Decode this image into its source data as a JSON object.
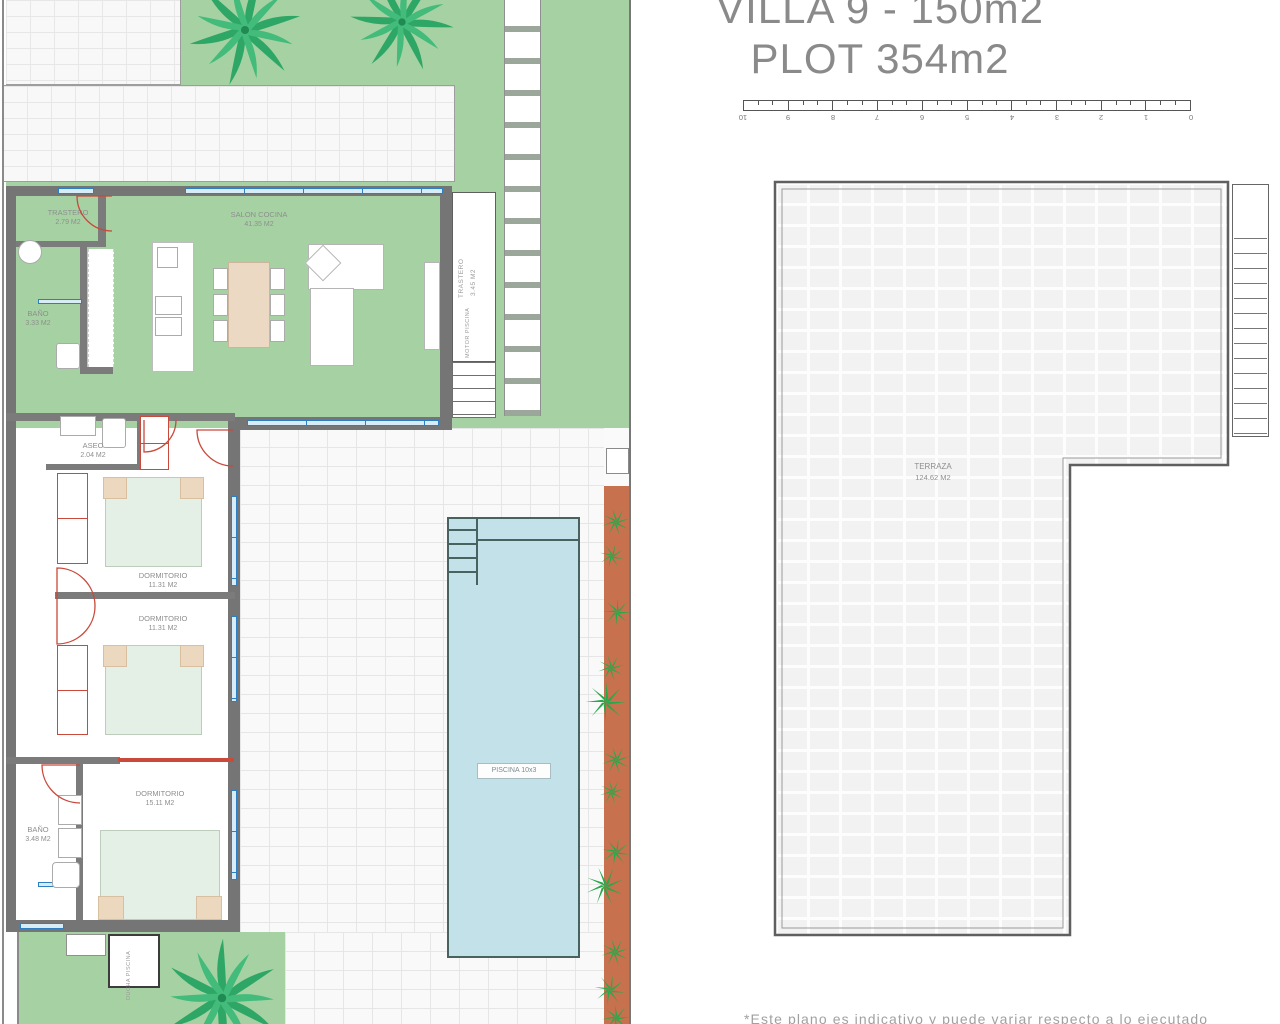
{
  "title": {
    "line1": "VILLA 9 - 150m2",
    "line2": "PLOT 354m2"
  },
  "scale_bar": {
    "numbers": [
      "10",
      "9",
      "8",
      "7",
      "6",
      "5",
      "4",
      "3",
      "2",
      "1",
      "0"
    ]
  },
  "plan": {
    "trastero_top": {
      "name": "TRASTERO",
      "area": "2.79 M2"
    },
    "salon": {
      "name": "SALON COCINA",
      "area": "41.35 M2"
    },
    "bano_top": {
      "name": "BAÑO",
      "area": "3.33 M2"
    },
    "trastero_side": {
      "name": "TRASTERO",
      "area": "3.45 M2"
    },
    "motor_piscina": "MOTOR  PISCINA",
    "aseo": {
      "name": "ASEO",
      "area": "2.04 M2"
    },
    "dormitorio1": {
      "name": "DORMITORIO",
      "area": "11.31 M2"
    },
    "dormitorio2": {
      "name": "DORMITORIO",
      "area": "11.31 M2"
    },
    "dormitorio3": {
      "name": "DORMITORIO",
      "area": "15.11 M2"
    },
    "bano_bottom": {
      "name": "BAÑO",
      "area": "3.48 M2"
    },
    "ducha_piscina": "DUCHA  PISCINA",
    "piscina": "PISCINA 10x3"
  },
  "terrace_plan": {
    "name": "TERRAZA",
    "area": "124.62 M2"
  },
  "footnote": "*Este plano es indicativo y puede variar respecto a lo ejecutado",
  "colors": {
    "garden": "#a6d2a3",
    "pool": "#c3e1e8",
    "planter": "#c8714f",
    "wall": "#757575",
    "window": "#2e7fc1",
    "door": "#c9493b",
    "text": "#8e8e8e"
  }
}
